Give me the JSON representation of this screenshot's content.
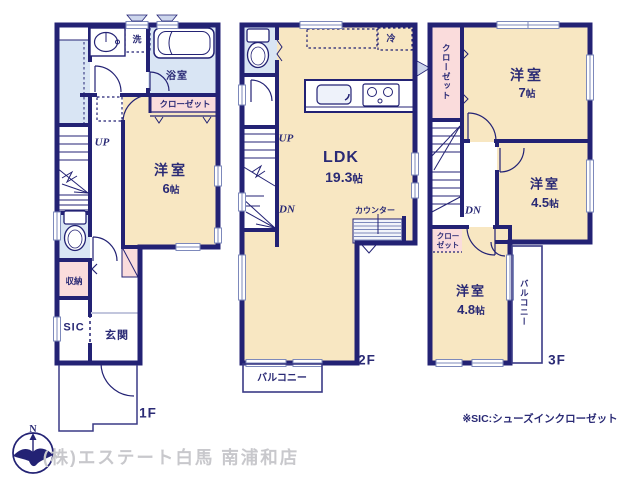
{
  "colors": {
    "wall_navy": "#232274",
    "room_beige": "#f8e7c2",
    "wet_blue": "#d9e5f4",
    "closet_pink": "#fadcdc",
    "window_line": "#7d89bb",
    "company_gray": "#c8c8cc"
  },
  "floor1": {
    "floor_label": "1F",
    "washer": "洗",
    "bath": "浴室",
    "closet": "クローゼット",
    "room": {
      "name": "洋室",
      "size_num": "6",
      "size_unit": "帖"
    },
    "up": "UP",
    "storage": "収納",
    "sic": "SIC",
    "entrance": "玄関"
  },
  "floor2": {
    "floor_label": "2F",
    "fridge": "冷",
    "ldk": {
      "name": "LDK",
      "size_num": "19.3",
      "size_unit": "帖"
    },
    "counter": "カウンター",
    "up": "UP",
    "dn": "DN",
    "balcony": "バルコニー"
  },
  "floor3": {
    "floor_label": "3F",
    "closet": "クローゼット",
    "room7": {
      "name": "洋室",
      "size_num": "7",
      "size_unit": "帖"
    },
    "room45": {
      "name": "洋室",
      "size_num": "4.5",
      "size_unit": "帖"
    },
    "closet_small_line1": "クロー",
    "closet_small_line2": "ゼット",
    "room48": {
      "name": "洋室",
      "size_num": "4.8",
      "size_unit": "帖"
    },
    "dn": "DN",
    "balcony": "バルコニー"
  },
  "footer": {
    "note": "※SIC:シューズインクローゼット",
    "company": "(株)エステート白馬 南浦和店",
    "compass_n": "N"
  }
}
